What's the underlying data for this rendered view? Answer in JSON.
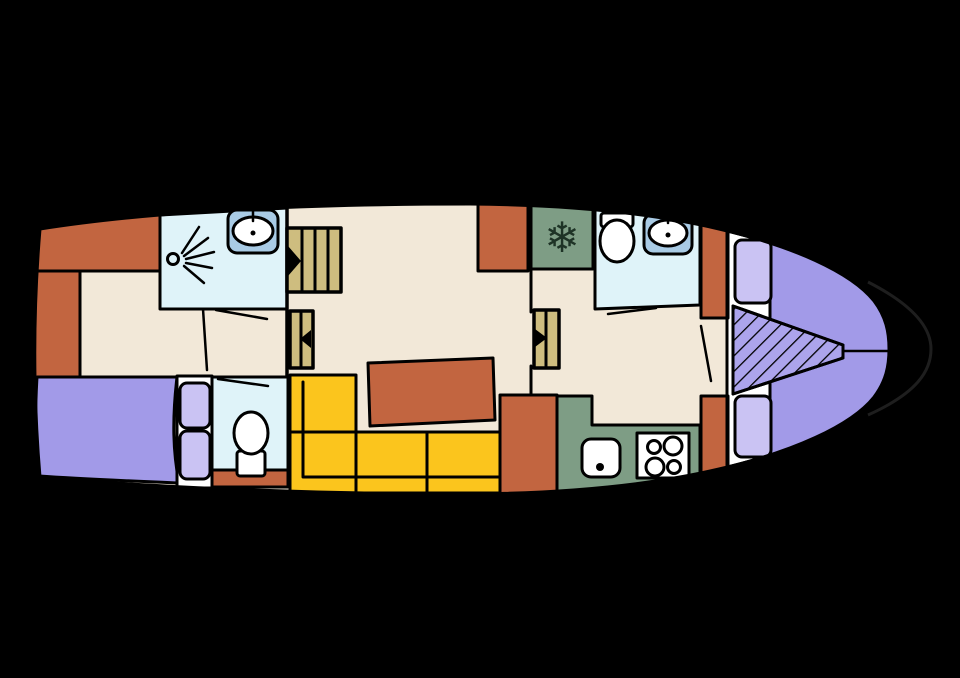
{
  "scene": {
    "type": "boat-floor-plan",
    "background": "#000000"
  },
  "palette": {
    "hull_white": "#ffffff",
    "floor_beige": "#f2e8d8",
    "cabinet_orange": "#c26540",
    "sofa_yellow": "#fbc51d",
    "table_orange": "#c26540",
    "bed_purple": "#a29ae8",
    "pillow_purple": "#cac3f3",
    "hatch_purple": "#aca4ec",
    "wetroom_blue": "#dff3f9",
    "sink_blue": "#a9cbe5",
    "galley_green": "#7e9d85",
    "stair_tan": "#cebd7f",
    "fixture_white": "#ffffff",
    "snowflake_green": "#1e3326",
    "bow_outline": "#1e1e1e",
    "line_black": "#000000"
  },
  "icons": {
    "snowflake": "❄"
  }
}
